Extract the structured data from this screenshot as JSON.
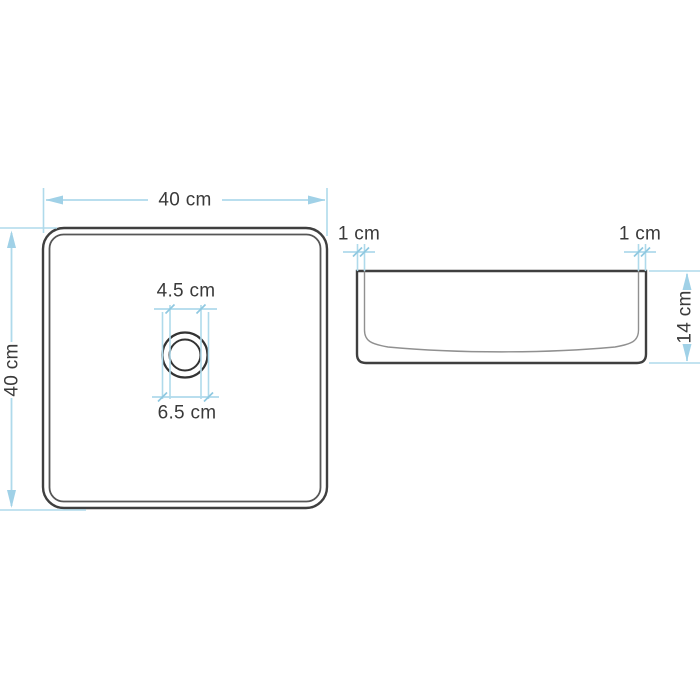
{
  "colors": {
    "dimension_blue": "#afdaeb",
    "arrow_blue": "#a0d1e7",
    "outline_dark": "#3f3f3f",
    "inner_line_gray": "#909090",
    "label_text": "#3a3a3a",
    "background": "#ffffff"
  },
  "top_view": {
    "width": "40 cm",
    "height": "40 cm",
    "drain_inner_diameter": "4.5 cm",
    "drain_outer_diameter": "6.5 cm"
  },
  "side_view": {
    "left_wall_thickness": "1 cm",
    "right_wall_thickness": "1 cm",
    "height": "14 cm"
  }
}
